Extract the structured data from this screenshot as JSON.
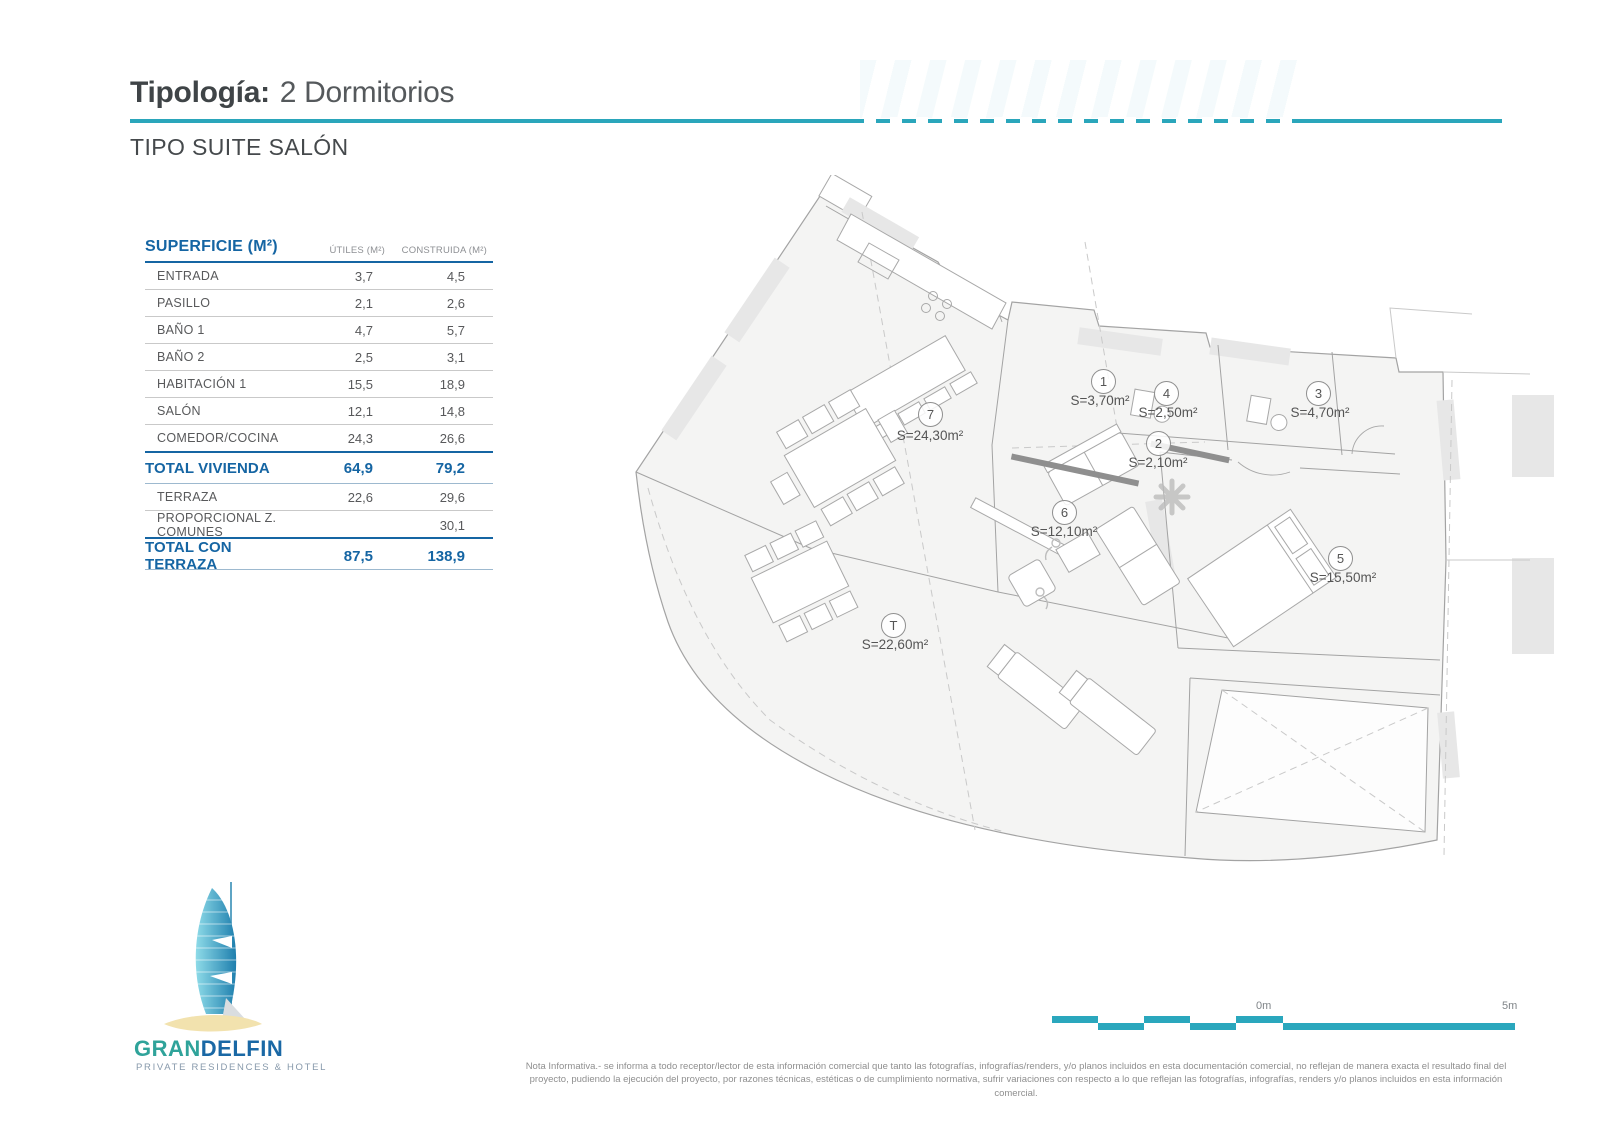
{
  "header": {
    "title_label": "Tipología:",
    "title_value": "2 Dormitorios",
    "subtitle": "TIPO SUITE SALÓN"
  },
  "table": {
    "title": "SUPERFICIE (M²)",
    "col_utiles": "ÚTILES (M²)",
    "col_construida": "CONSTRUIDA (M²)",
    "rows": [
      {
        "label": "ENTRADA",
        "utiles": "3,7",
        "construida": "4,5"
      },
      {
        "label": "PASILLO",
        "utiles": "2,1",
        "construida": "2,6"
      },
      {
        "label": "BAÑO 1",
        "utiles": "4,7",
        "construida": "5,7"
      },
      {
        "label": "BAÑO 2",
        "utiles": "2,5",
        "construida": "3,1"
      },
      {
        "label": "HABITACIÓN 1",
        "utiles": "15,5",
        "construida": "18,9"
      },
      {
        "label": "SALÓN",
        "utiles": "12,1",
        "construida": "14,8"
      },
      {
        "label": "COMEDOR/COCINA",
        "utiles": "24,3",
        "construida": "26,6"
      },
      {
        "label": "TOTAL VIVIENDA",
        "utiles": "64,9",
        "construida": "79,2"
      },
      {
        "label": "TERRAZA",
        "utiles": "22,6",
        "construida": "29,6"
      },
      {
        "label": "PROPORCIONAL Z. COMUNES",
        "utiles": "",
        "construida": "30,1"
      },
      {
        "label": "TOTAL CON TERRAZA",
        "utiles": "87,5",
        "construida": "138,9"
      }
    ]
  },
  "floorplan": {
    "rooms": [
      {
        "num": "7",
        "area": "S=24,30m²"
      },
      {
        "num": "1",
        "area": "S=3,70m²"
      },
      {
        "num": "4",
        "area": "S=2,50m²"
      },
      {
        "num": "3",
        "area": "S=4,70m²"
      },
      {
        "num": "2",
        "area": "S=2,10m²"
      },
      {
        "num": "6",
        "area": "S=12,10m²"
      },
      {
        "num": "5",
        "area": "S=15,50m²"
      },
      {
        "num": "T",
        "area": "S=22,60m²"
      }
    ]
  },
  "scale_bar": {
    "zero_label": "0m",
    "five_label": "5m"
  },
  "logo": {
    "brand_gran": "GRAN",
    "brand_delfin": "DELFIN",
    "tagline": "PRIVATE RESIDENCES & HOTEL"
  },
  "footnote": "Nota Informativa.- se informa a todo receptor/lector de esta información comercial que tanto las fotografías, infografías/renders, y/o planos incluidos en esta documentación comercial, no reflejan de manera exacta el resultado final del proyecto, pudiendo la ejecución del proyecto, por razones técnicas, estéticas o de cumplimiento normativa, sufrir variaciones con respecto a lo que reflejan las fotografías, infografías, renders y/o planos incluidos en esta información comercial.",
  "colors": {
    "accent_teal": "#2aa6bb",
    "table_blue": "#1565a3"
  }
}
